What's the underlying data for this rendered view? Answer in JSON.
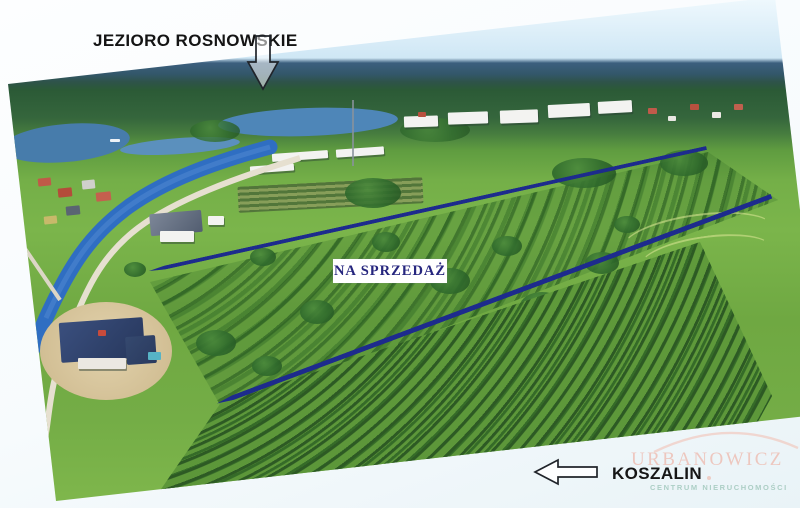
{
  "annotations": {
    "lake": {
      "label": "JEZIORO ROSNOWSKIE"
    },
    "for_sale": {
      "label": "NA SPRZEDAŻ"
    },
    "city": {
      "label": "KOSZALIN"
    }
  },
  "watermark": {
    "name": "URBANOWICZ",
    "tagline": "CENTRUM NIERUCHOMOŚCI"
  },
  "icons": {
    "down_arrow": "down-arrow-icon",
    "left_arrow": "left-arrow-icon",
    "arc": "watermark-arc-icon"
  },
  "colors": {
    "boundary_line": "#1d2b8d",
    "for_sale_text": "#26267e",
    "for_sale_background": "#ffffff",
    "annotation_text": "#141414",
    "watermark_name": "#eec3b9",
    "watermark_tagline": "#a9cdc3",
    "canal_water": "#2f6ec2",
    "lake_water": "#4e86b8"
  }
}
